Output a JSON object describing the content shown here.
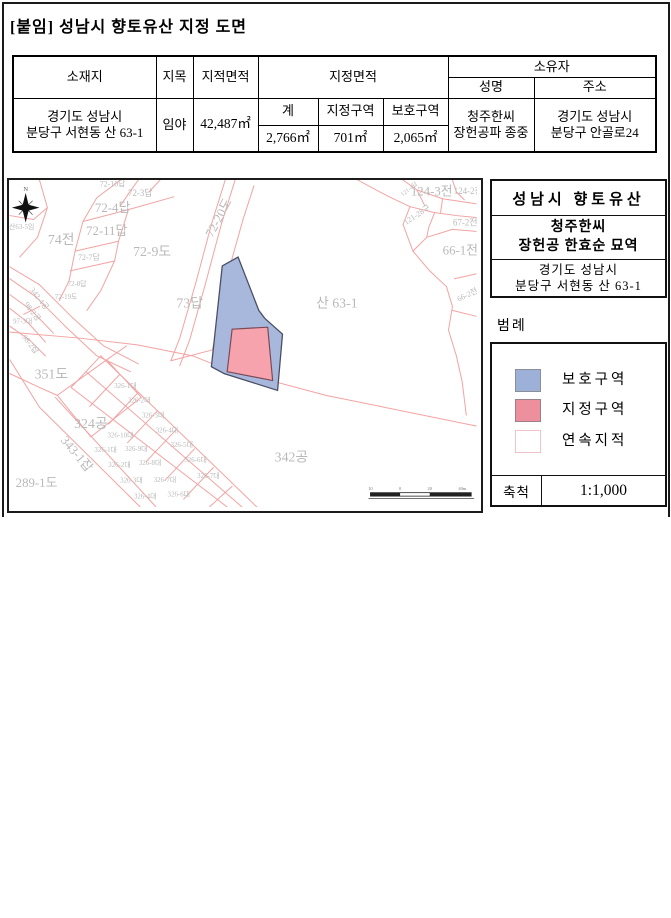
{
  "page": {
    "title": "[붙임] 성남시 향토유산 지정 도면"
  },
  "table": {
    "headers": {
      "location": "소재지",
      "land_category": "지목",
      "cadastral_area": "지적면적",
      "designated_area": "지정면적",
      "owner": "소유자",
      "owner_name": "성명",
      "owner_address": "주소",
      "total": "계",
      "designated_zone": "지정구역",
      "protection_zone": "보호구역"
    },
    "row": {
      "location_line1": "경기도 성남시",
      "location_line2": "분당구 서현동 산 63-1",
      "land_category": "임야",
      "cadastral_area": "42,487㎡",
      "total_area": "2,766㎡",
      "designated_zone_area": "701㎡",
      "protection_zone_area": "2,065㎡",
      "owner_name_line1": "청주한씨",
      "owner_name_line2": "장헌공파 종중",
      "owner_address_line1": "경기도 성남시",
      "owner_address_line2": "분당구 안골로24"
    }
  },
  "map": {
    "compass_label": "N",
    "colors": {
      "protection_fill": "#a8b7dc",
      "protection_stroke": "#4a4f63",
      "designated_fill": "#f7a3ae",
      "designated_stroke": "#7a4a55",
      "parcel_line": "#f3a2a2",
      "label_gray": "#b9b9b9"
    },
    "parcel_labels": [
      {
        "t": "산63-5임",
        "x": 12,
        "y": 47,
        "s": 7
      },
      {
        "t": "74전",
        "x": 52,
        "y": 60,
        "s": 14
      },
      {
        "t": "72-4답",
        "x": 104,
        "y": 28,
        "s": 13
      },
      {
        "t": "72-11답",
        "x": 98,
        "y": 51,
        "s": 13
      },
      {
        "t": "72-10답",
        "x": 104,
        "y": 4,
        "s": 8
      },
      {
        "t": "72-3답",
        "x": 132,
        "y": 13,
        "s": 9
      },
      {
        "t": "72-7답",
        "x": 80,
        "y": 78,
        "s": 8
      },
      {
        "t": "72-8답",
        "x": 68,
        "y": 105,
        "s": 7
      },
      {
        "t": "72-19도",
        "x": 57,
        "y": 118,
        "s": 7
      },
      {
        "t": "72-9도",
        "x": 144,
        "y": 72,
        "s": 14
      },
      {
        "t": "72-20도",
        "x": 211,
        "y": 38,
        "s": 13,
        "r": -62
      },
      {
        "t": "73답",
        "x": 182,
        "y": 124,
        "s": 14
      },
      {
        "t": "산 63-1",
        "x": 331,
        "y": 124,
        "s": 14
      },
      {
        "t": "124-3전",
        "x": 427,
        "y": 11,
        "s": 13
      },
      {
        "t": "124-2전",
        "x": 464,
        "y": 11,
        "s": 9
      },
      {
        "t": "121-4답",
        "x": 404,
        "y": 9,
        "s": 6,
        "r": -38
      },
      {
        "t": "121-28구",
        "x": 412,
        "y": 35,
        "s": 8,
        "r": -33
      },
      {
        "t": "67-2전",
        "x": 461,
        "y": 43,
        "s": 9
      },
      {
        "t": "66-1전",
        "x": 456,
        "y": 71,
        "s": 13
      },
      {
        "t": "66-2전",
        "x": 463,
        "y": 116,
        "s": 8,
        "r": -25
      },
      {
        "t": "342-4공",
        "x": 30,
        "y": 120,
        "s": 8,
        "r": 52
      },
      {
        "t": "98-2공",
        "x": 23,
        "y": 133,
        "s": 8,
        "r": 52
      },
      {
        "t": "97-3대",
        "x": 13,
        "y": 143,
        "s": 7
      },
      {
        "t": "98-2잡",
        "x": 21,
        "y": 166,
        "s": 8,
        "r": 52
      },
      {
        "t": "351도",
        "x": 42,
        "y": 196,
        "s": 14
      },
      {
        "t": "324공",
        "x": 82,
        "y": 246,
        "s": 14
      },
      {
        "t": "343-1잡",
        "x": 68,
        "y": 277,
        "s": 13,
        "r": 50
      },
      {
        "t": "289-1도",
        "x": 27,
        "y": 306,
        "s": 13
      },
      {
        "t": "342공",
        "x": 285,
        "y": 280,
        "s": 14
      },
      {
        "t": "326-1대",
        "x": 117,
        "y": 208,
        "s": 7
      },
      {
        "t": "326-2대",
        "x": 131,
        "y": 223,
        "s": 7
      },
      {
        "t": "326-3대",
        "x": 145,
        "y": 238,
        "s": 7
      },
      {
        "t": "326-4대",
        "x": 159,
        "y": 253,
        "s": 7
      },
      {
        "t": "326-5대",
        "x": 174,
        "y": 268,
        "s": 7
      },
      {
        "t": "326-6대",
        "x": 188,
        "y": 283,
        "s": 7
      },
      {
        "t": "326-7대",
        "x": 201,
        "y": 299,
        "s": 7
      },
      {
        "t": "326-10대",
        "x": 112,
        "y": 258,
        "s": 7
      },
      {
        "t": "326-9대",
        "x": 128,
        "y": 272,
        "s": 7
      },
      {
        "t": "326-8대",
        "x": 142,
        "y": 286,
        "s": 7
      },
      {
        "t": "326-7대",
        "x": 157,
        "y": 303,
        "s": 7
      },
      {
        "t": "326-6대",
        "x": 171,
        "y": 318,
        "s": 7
      },
      {
        "t": "326-1대",
        "x": 97,
        "y": 273,
        "s": 7
      },
      {
        "t": "326-2대",
        "x": 111,
        "y": 288,
        "s": 7
      },
      {
        "t": "326-3대",
        "x": 123,
        "y": 304,
        "s": 7
      },
      {
        "t": "326-4대",
        "x": 137,
        "y": 320,
        "s": 7
      }
    ],
    "scale_bar_labels": [
      "10",
      "0",
      "20",
      "40m"
    ]
  },
  "info_panel": {
    "title": "성남시 향토유산",
    "name_line1": "청주한씨",
    "name_line2": "장헌공 한효순 묘역",
    "address_line1": "경기도 성남시",
    "address_line2": "분당구 서현동 산 63-1"
  },
  "legend": {
    "label": "범례",
    "items": [
      {
        "label": "보호구역",
        "color": "#9db0d8",
        "border": "#8a8f9a"
      },
      {
        "label": "지정구역",
        "color": "#ee8f9d",
        "border": "#9a8188"
      },
      {
        "label": "연속지적",
        "color": "#ffffff",
        "border": "#f0c3cb"
      }
    ],
    "scale_label": "축척",
    "scale_value": "1:1,000"
  }
}
